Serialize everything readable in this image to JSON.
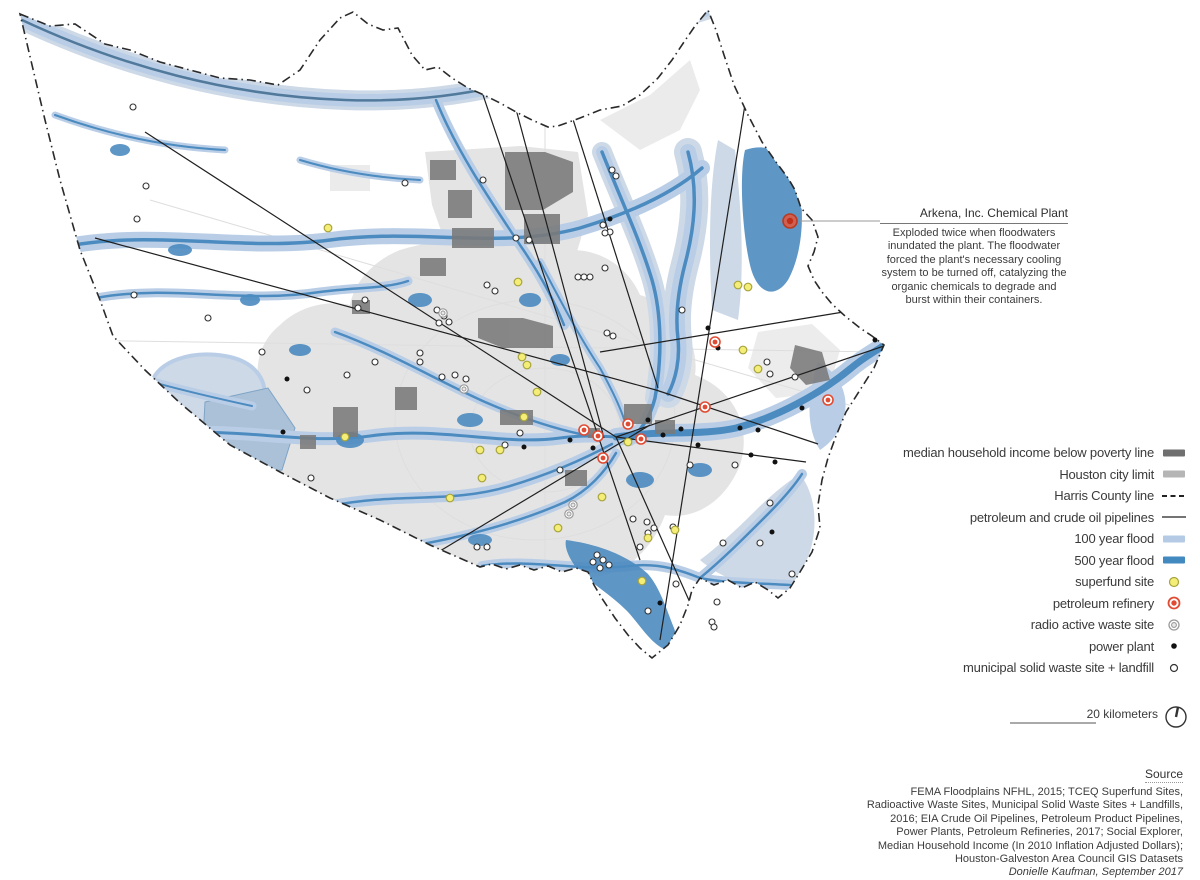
{
  "annotation": {
    "title": "Arkena, Inc. Chemical Plant",
    "body": "Exploded twice when floodwaters inundated the plant. The floodwater forced the plant's necessary cooling system to be turned off, catalyzing the organic chemicals to degrade and burst within their containers."
  },
  "legend": {
    "items": [
      {
        "label": "median household income below poverty line",
        "symbol": "swatch",
        "icon": "poverty-swatch",
        "color": "#6f6f6f"
      },
      {
        "label": "Houston city limit",
        "symbol": "swatch",
        "icon": "city-limit-swatch",
        "color": "#b5b5b5"
      },
      {
        "label": "Harris County line",
        "symbol": "dashed-line",
        "icon": "county-line-dash",
        "color": "#222222"
      },
      {
        "label": "petroleum and crude oil pipelines",
        "symbol": "line",
        "icon": "pipeline-line",
        "color": "#222222"
      },
      {
        "label": "100 year flood",
        "symbol": "swatch",
        "icon": "flood-100-swatch",
        "color": "#b5cbe5"
      },
      {
        "label": "500 year flood",
        "symbol": "swatch",
        "icon": "flood-500-swatch",
        "color": "#4189bf"
      },
      {
        "label": "superfund site",
        "symbol": "circle",
        "icon": "superfund-icon",
        "fill": "#f4ee79",
        "stroke": "#a8a43c"
      },
      {
        "label": "petroleum refinery",
        "symbol": "target",
        "icon": "refinery-icon",
        "color": "#e04c33"
      },
      {
        "label": "radio active waste site",
        "symbol": "double-circle",
        "icon": "radioactive-icon",
        "color": "#9a9a9a"
      },
      {
        "label": "power plant",
        "symbol": "dot",
        "icon": "power-plant-icon",
        "color": "#111111"
      },
      {
        "label": "municipal solid waste site + landfill",
        "symbol": "open-circle",
        "icon": "landfill-icon",
        "color": "#333333"
      }
    ]
  },
  "scale": {
    "label": "20 kilometers"
  },
  "source": {
    "title": "Source",
    "lines": [
      "FEMA Floodplains NFHL, 2015; TCEQ Superfund Sites,",
      "Radioactive Waste Sites, Municipal Solid Waste Sites + Landfills,",
      "2016; EIA Crude Oil Pipelines, Petroleum Product Pipelines,",
      "Power Plants, Petroleum Refineries, 2017; Social Explorer,",
      "Median Household Income (In 2010 Inflation Adjusted Dollars);",
      "Houston-Galveston Area Council GIS Datasets"
    ],
    "credit": "Donielle Kaufman, September 2017"
  },
  "map": {
    "colors": {
      "flood_100": "#b9cee6",
      "flood_500": "#4c8bc0",
      "flood_pale": "#cdd9e7",
      "city_limit": "#e4e4e4",
      "poverty": "#7a7a7a",
      "pipeline": "#1f1f1f",
      "county_line": "#2a2a2a",
      "refinery": "#e04c33",
      "superfund_fill": "#f4ee79",
      "superfund_stroke": "#a8a43c",
      "radioactive": "#9a9a9a",
      "power": "#111111",
      "landfill_stroke": "#333333"
    },
    "featured_site": {
      "name": "Arkena, Inc. Chemical Plant",
      "x": 790,
      "y": 221
    },
    "markers": {
      "landfills": [
        [
          133,
          107
        ],
        [
          146,
          186
        ],
        [
          137,
          219
        ],
        [
          134,
          295
        ],
        [
          208,
          318
        ],
        [
          262,
          352
        ],
        [
          311,
          478
        ],
        [
          347,
          375
        ],
        [
          307,
          390
        ],
        [
          405,
          183
        ],
        [
          483,
          180
        ],
        [
          516,
          238
        ],
        [
          529,
          240
        ],
        [
          487,
          285
        ],
        [
          495,
          291
        ],
        [
          358,
          308
        ],
        [
          365,
          300
        ],
        [
          437,
          310
        ],
        [
          444,
          316
        ],
        [
          449,
          322
        ],
        [
          439,
          323
        ],
        [
          375,
          362
        ],
        [
          420,
          353
        ],
        [
          420,
          362
        ],
        [
          442,
          377
        ],
        [
          455,
          375
        ],
        [
          466,
          379
        ],
        [
          612,
          170
        ],
        [
          616,
          176
        ],
        [
          603,
          225
        ],
        [
          610,
          232
        ],
        [
          605,
          233
        ],
        [
          578,
          277
        ],
        [
          584,
          277
        ],
        [
          590,
          277
        ],
        [
          605,
          268
        ],
        [
          682,
          310
        ],
        [
          607,
          333
        ],
        [
          613,
          336
        ],
        [
          767,
          362
        ],
        [
          770,
          374
        ],
        [
          795,
          377
        ],
        [
          560,
          470
        ],
        [
          690,
          465
        ],
        [
          735,
          465
        ],
        [
          770,
          503
        ],
        [
          723,
          543
        ],
        [
          597,
          555
        ],
        [
          603,
          560
        ],
        [
          609,
          565
        ],
        [
          600,
          568
        ],
        [
          593,
          562
        ],
        [
          647,
          522
        ],
        [
          654,
          528
        ],
        [
          648,
          533
        ],
        [
          673,
          527
        ],
        [
          633,
          519
        ],
        [
          640,
          547
        ],
        [
          676,
          584
        ],
        [
          648,
          611
        ],
        [
          712,
          622
        ],
        [
          714,
          627
        ],
        [
          717,
          602
        ],
        [
          760,
          543
        ],
        [
          792,
          574
        ],
        [
          520,
          433
        ],
        [
          505,
          445
        ],
        [
          487,
          547
        ],
        [
          477,
          547
        ]
      ],
      "power_plants": [
        [
          610,
          219
        ],
        [
          287,
          379
        ],
        [
          283,
          432
        ],
        [
          708,
          328
        ],
        [
          718,
          348
        ],
        [
          648,
          420
        ],
        [
          663,
          435
        ],
        [
          681,
          429
        ],
        [
          698,
          445
        ],
        [
          740,
          428
        ],
        [
          751,
          455
        ],
        [
          775,
          462
        ],
        [
          802,
          408
        ],
        [
          875,
          340
        ],
        [
          758,
          430
        ],
        [
          570,
          440
        ],
        [
          593,
          448
        ],
        [
          660,
          603
        ],
        [
          524,
          447
        ],
        [
          772,
          532
        ]
      ],
      "superfund_sites": [
        [
          328,
          228
        ],
        [
          518,
          282
        ],
        [
          522,
          357
        ],
        [
          527,
          365
        ],
        [
          524,
          417
        ],
        [
          537,
          392
        ],
        [
          345,
          437
        ],
        [
          480,
          450
        ],
        [
          500,
          450
        ],
        [
          482,
          478
        ],
        [
          450,
          498
        ],
        [
          558,
          528
        ],
        [
          602,
          497
        ],
        [
          628,
          442
        ],
        [
          648,
          538
        ],
        [
          642,
          581
        ],
        [
          675,
          530
        ],
        [
          738,
          285
        ],
        [
          748,
          287
        ],
        [
          743,
          350
        ],
        [
          758,
          369
        ]
      ],
      "radioactive_sites": [
        [
          464,
          389
        ],
        [
          573,
          505
        ],
        [
          569,
          514
        ],
        [
          443,
          313
        ]
      ],
      "refineries": [
        [
          715,
          342
        ],
        [
          705,
          407
        ],
        [
          828,
          400
        ],
        [
          598,
          436
        ],
        [
          584,
          430
        ],
        [
          628,
          424
        ],
        [
          641,
          439
        ],
        [
          603,
          458
        ]
      ]
    }
  }
}
